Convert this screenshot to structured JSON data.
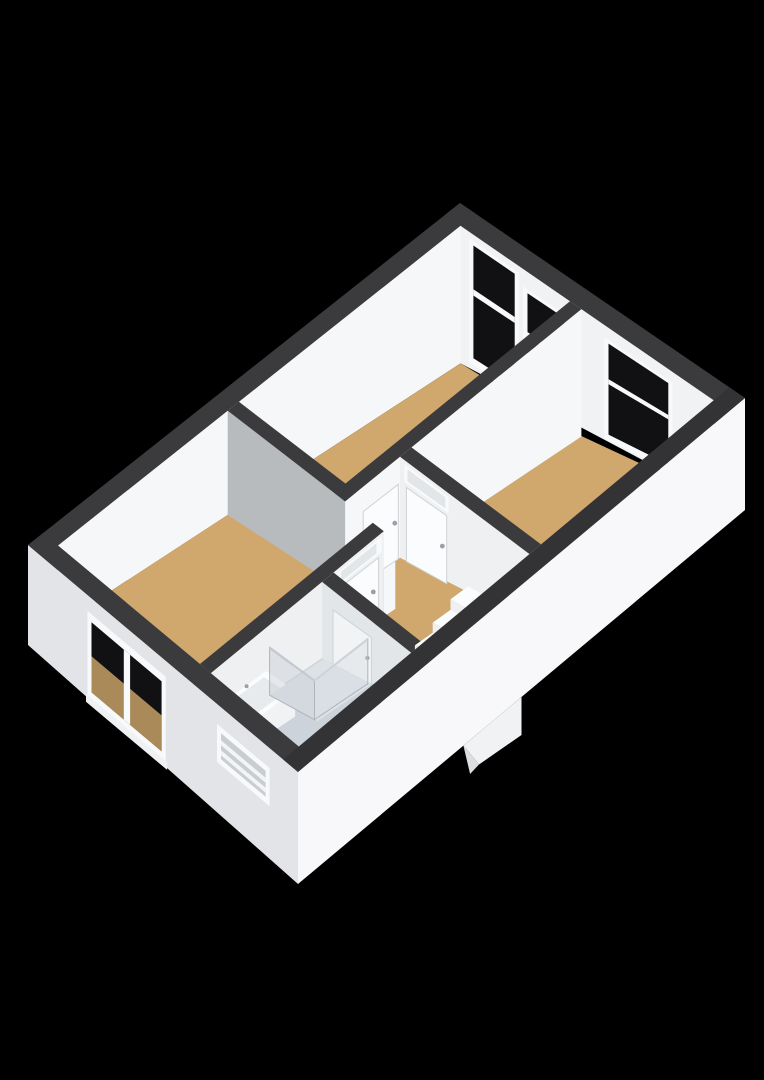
{
  "scene": {
    "type": "3d-floorplan-axonometric",
    "background": "#000000",
    "width": 764,
    "height": 1080
  },
  "colors": {
    "background": "#000000",
    "wall_top": "#3b3b3e",
    "wall_top_near": "#333336",
    "face_bright": "#f6f7f8",
    "face_light": "#eef0f2",
    "face_mid": "#e3e6e9",
    "face_gray": "#b7bbbe",
    "facade_left": "#e3e4e7",
    "facade_front": "#f8f8fa",
    "floor_wood": "#d0a76d",
    "floor_bath": "#ccd3da",
    "shower_tray": "#dde2e6",
    "glass_dark": "#111113",
    "frame_white": "#f8f9fa",
    "door_white": "#fbfcfd",
    "door_shadow": "#f1f3f5",
    "door_outline": "#cmd",
    "outline_gray": "#cfd3d6",
    "transom_glass": "#e2e6e9",
    "window_slats": "#c9ccd0",
    "slat_bar": "#f3f4f6",
    "metal": "#9aa0a6",
    "tan_glimpse": "#c7a066",
    "sink_side": "#e6e9eb",
    "sink_front": "#f0f2f4",
    "sink_top": "#fbfcfd",
    "basin": "#e8ebed",
    "step_top": "#fbfcfd",
    "step_riser": "#eef0f2",
    "step_side": "#f3f4f6",
    "shower_glass_a": "rgba(198,206,213,0.42)",
    "shower_glass_b": "rgba(212,219,225,0.36)",
    "shower_frame": "#aeb5bb"
  },
  "building": {
    "rooms": [
      {
        "id": "bedroom-large",
        "floor": "wood"
      },
      {
        "id": "bedroom-left",
        "floor": "wood"
      },
      {
        "id": "bedroom-right",
        "floor": "wood"
      },
      {
        "id": "hallway-landing",
        "floor": "wood"
      },
      {
        "id": "bathroom",
        "floor": "tile"
      }
    ],
    "fixtures": [
      "sink",
      "shower-enclosure",
      "staircase",
      "stairwell-volume"
    ],
    "windows": {
      "top_right_wall": 3,
      "bottom_left_facade": 2
    },
    "doors": {
      "interior_total": 4,
      "with_transom": 2
    }
  }
}
